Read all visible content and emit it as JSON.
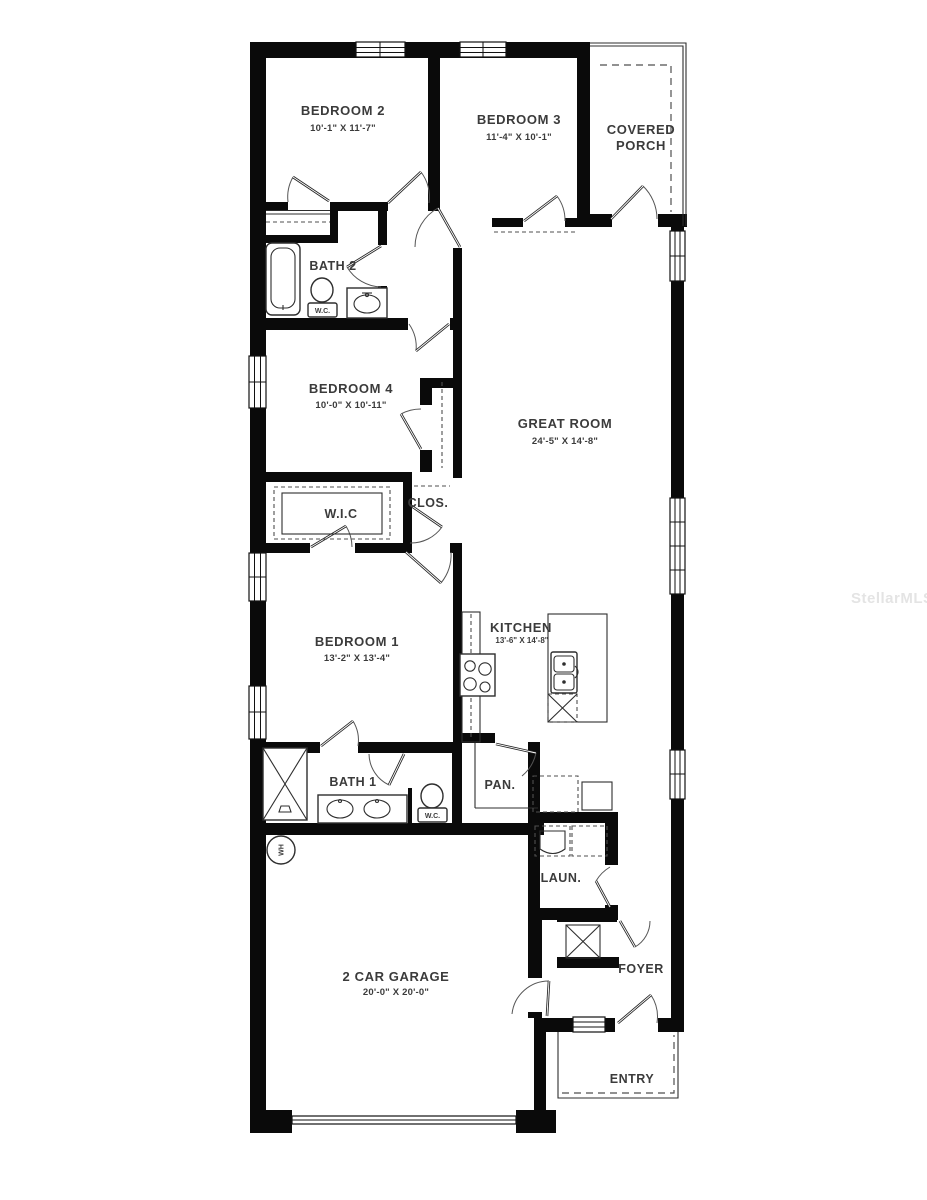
{
  "watermark": "StellarMLS",
  "rooms": {
    "bedroom2": {
      "label": "BEDROOM 2",
      "dims": "10'-1\" X 11'-7\""
    },
    "bedroom3": {
      "label": "BEDROOM 3",
      "dims": "11'-4\" X 10'-1\""
    },
    "covered_porch": {
      "line1": "COVERED",
      "line2": "PORCH"
    },
    "bath2": {
      "label": "BATH 2"
    },
    "bedroom4": {
      "label": "BEDROOM 4",
      "dims": "10'-0\" X 10'-11\""
    },
    "great_room": {
      "label": "GREAT ROOM",
      "dims": "24'-5\" X 14'-8\""
    },
    "wic": {
      "label": "W.I.C"
    },
    "closet": {
      "label": "CLOS."
    },
    "bedroom1": {
      "label": "BEDROOM 1",
      "dims": "13'-2\" X 13'-4\""
    },
    "kitchen": {
      "label": "KITCHEN",
      "dims": "13'-6\" X 14'-8\""
    },
    "bath1": {
      "label": "BATH 1"
    },
    "pantry": {
      "label": "PAN."
    },
    "laundry": {
      "label": "LAUN."
    },
    "foyer": {
      "label": "FOYER"
    },
    "garage": {
      "label": "2 CAR GARAGE",
      "dims": "20'-0\" X 20'-0\""
    },
    "entry": {
      "label": "ENTRY"
    }
  },
  "fixtures": {
    "wc_label": "W.C.",
    "water_heater_label": "WH"
  },
  "colors": {
    "wall": "#0a0a0a",
    "line": "#2e2e2e",
    "dashed": "#4f4f4f",
    "text": "#3b3b3b",
    "watermark": "#e4e4e4",
    "background": "#ffffff"
  }
}
